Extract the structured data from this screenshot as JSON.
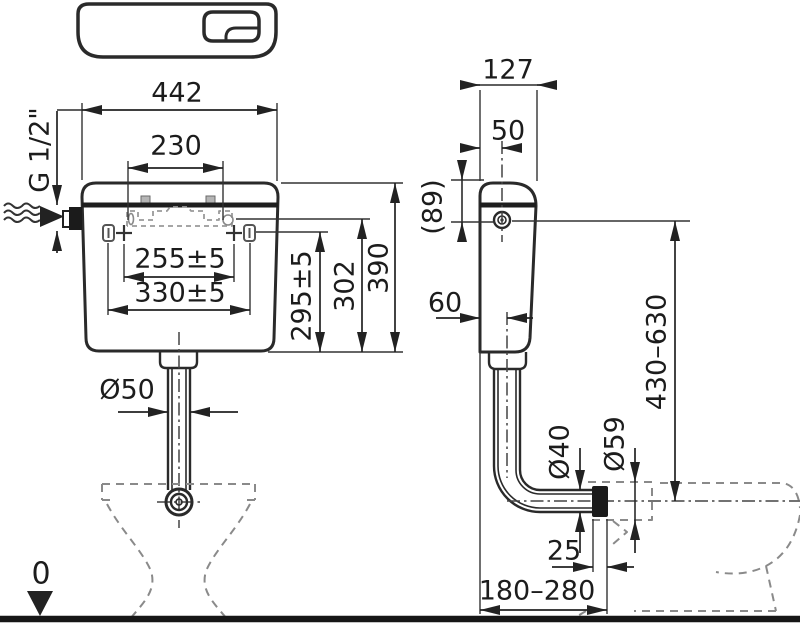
{
  "drawing": {
    "type": "technical-installation-diagram",
    "subject": "WC flush cistern with flush pipe and bowl, front and side views",
    "colors": {
      "background": "#ffffff",
      "line": "#2a2a2a",
      "hidden_line": "#8a8a8a",
      "floor_line": "#161616"
    },
    "icon": "dual-flush-cistern-top-view-icon",
    "front_view": {
      "overall_width": "442",
      "lid_span": "230",
      "fixing_centres_inner": "255±5",
      "fixing_centres_outer": "330±5",
      "fixing_height_inner": "295±5",
      "fixing_height_outer": "302",
      "overall_height": "390",
      "flush_pipe_diameter": "Ø50",
      "water_inlet_thread": "G 1/2\"",
      "floor_level": "0"
    },
    "side_view": {
      "overall_depth": "127",
      "inlet_offset_from_wall": "50",
      "inlet_height_from_top": "(89)",
      "bottom_depth_to_pipe_axis": "60",
      "flush_pipe_height_range": "430–630",
      "flush_pipe_diameter": "Ø40",
      "connector_diameter": "Ø59",
      "insertion_depth": "25",
      "wall_to_bowl_inlet_range": "180–280"
    }
  }
}
